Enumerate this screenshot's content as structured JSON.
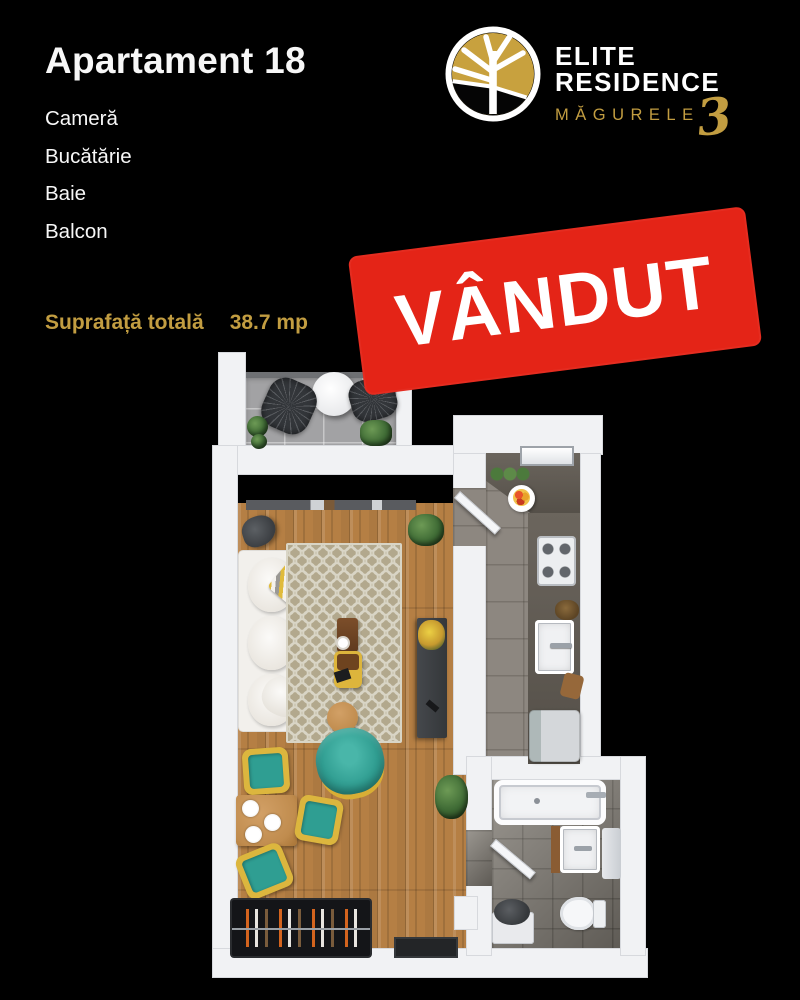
{
  "colors": {
    "bg": "#000000",
    "text": "#f7f7f7",
    "gold": "#c29d41",
    "stampRed": "#e42417",
    "wall": "#f1f2f4",
    "wood": "#b57f44",
    "teal": "#31a094",
    "chairYellow": "#dcb63e"
  },
  "header": {
    "title": "Apartament 18",
    "rooms": [
      "Cameră",
      "Bucătărie",
      "Baie",
      "Balcon"
    ],
    "area_label": "Suprafață totală",
    "area_value": "38.7 mp"
  },
  "logo": {
    "name_line1": "ELITE",
    "name_line2": "RESIDENCE",
    "location": "MĂGURELE",
    "phase": "3"
  },
  "stamp": {
    "label": "VÂNDUT"
  },
  "floorplan": {
    "rooms_shown": [
      "balcon",
      "camera",
      "bucatarie",
      "baie"
    ],
    "style": "3d-top-down-render"
  }
}
